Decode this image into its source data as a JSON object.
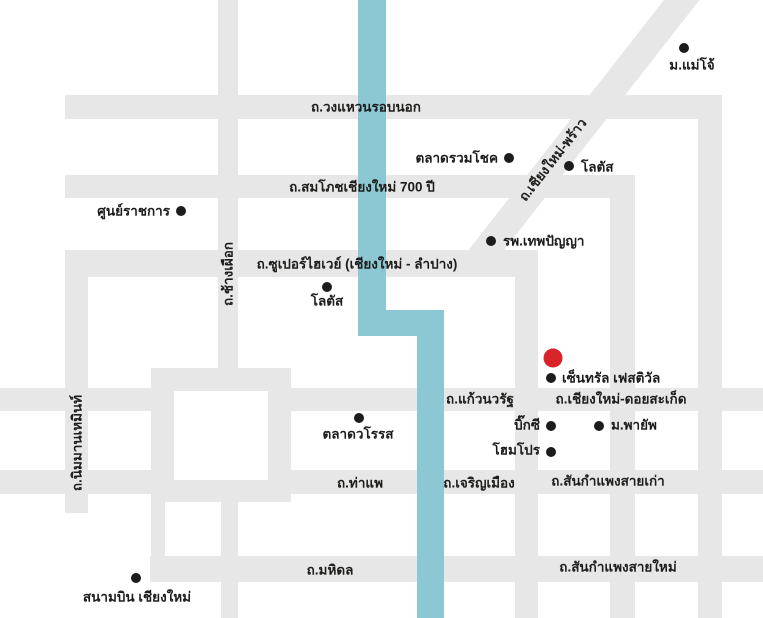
{
  "map": {
    "title": "chiangmai-schematic-map",
    "colors": {
      "background": "#ffffff",
      "road": "#e7e7e7",
      "river": "#8cc7d4",
      "marker": "#1c1c1c",
      "highlight": "#d8232b",
      "label": "#1d1d1b"
    },
    "road_segments": [
      {
        "id": "outer-ring-north",
        "rect": [
          65,
          95,
          657,
          24
        ]
      },
      {
        "id": "outer-ring-east",
        "rect": [
          698,
          95,
          24,
          523
        ]
      },
      {
        "id": "somphot-700pi",
        "rect": [
          65,
          175,
          570,
          23
        ]
      },
      {
        "id": "somphot-south-branch",
        "rect": [
          610,
          175,
          25,
          443
        ]
      },
      {
        "id": "superhighway",
        "rect": [
          65,
          250,
          473,
          27
        ]
      },
      {
        "id": "superhighway-south-branch",
        "rect": [
          515,
          250,
          23,
          368
        ]
      },
      {
        "id": "chiangmai-phrao-diagonal",
        "rect": [
          570,
          -50,
          28,
          350
        ],
        "rotate": 38
      },
      {
        "id": "chang-phueak",
        "rect": [
          218,
          0,
          20,
          391
        ]
      },
      {
        "id": "nimmanhaemin",
        "rect": [
          65,
          250,
          23,
          263
        ]
      },
      {
        "id": "kaew-nawarat-west",
        "rect": [
          0,
          388,
          174,
          23
        ]
      },
      {
        "id": "doi-saket",
        "rect": [
          268,
          388,
          495,
          23
        ]
      },
      {
        "id": "tha-phae-west",
        "rect": [
          0,
          470,
          174,
          24
        ]
      },
      {
        "id": "charoen-mueang-east",
        "rect": [
          268,
          470,
          495,
          24
        ]
      },
      {
        "id": "mahidol",
        "rect": [
          150,
          556,
          613,
          26
        ]
      },
      {
        "id": "moat-square-top",
        "rect": [
          151,
          368,
          140,
          23
        ]
      },
      {
        "id": "moat-square-bottom",
        "rect": [
          151,
          480,
          140,
          22
        ]
      },
      {
        "id": "moat-square-west",
        "rect": [
          151,
          368,
          23,
          134
        ]
      },
      {
        "id": "moat-square-east",
        "rect": [
          268,
          368,
          23,
          134
        ]
      },
      {
        "id": "moat-stub-southwest",
        "rect": [
          151,
          495,
          14,
          65
        ]
      },
      {
        "id": "moat-stub-airport-line",
        "rect": [
          221,
          495,
          17,
          123
        ]
      }
    ],
    "road_labels": [
      {
        "id": "wong-waen-rob-nok",
        "text": "ถ.วงแหวนรอบนอก",
        "x": 366,
        "y": 107,
        "rotate": 0
      },
      {
        "id": "somphot-700pi",
        "text": "ถ.สมโภชเชียงใหม่ 700 ปี",
        "x": 362,
        "y": 187,
        "rotate": 0
      },
      {
        "id": "superhighway",
        "text": "ถ.ซูเปอร์ไฮเวย์ (เชียงใหม่ - ลำปาง)",
        "x": 357,
        "y": 264,
        "rotate": 0
      },
      {
        "id": "chiangmai-phrao",
        "text": "ถ.เชียงใหม่-พร้าว",
        "x": 553,
        "y": 160,
        "rotate": -52
      },
      {
        "id": "chang-phueak",
        "text": "ถ.ช้างเผือก",
        "x": 228,
        "y": 274,
        "rotate": -90
      },
      {
        "id": "nimmanhaemin",
        "text": "ถ.นิมมานเหมินท์",
        "x": 77,
        "y": 443,
        "rotate": -90
      },
      {
        "id": "kaew-nawarat",
        "text": "ถ.แก้วนวรัฐ",
        "x": 480,
        "y": 399,
        "rotate": 0
      },
      {
        "id": "chiangmai-doi-saket",
        "text": "ถ.เชียงใหม่-ดอยสะเก็ด",
        "x": 621,
        "y": 399,
        "rotate": 0
      },
      {
        "id": "tha-phae",
        "text": "ถ.ท่าแพ",
        "x": 360,
        "y": 483,
        "rotate": 0
      },
      {
        "id": "charoen-mueang",
        "text": "ถ.เจริญเมือง",
        "x": 479,
        "y": 483,
        "rotate": 0
      },
      {
        "id": "sankamphaeng-old",
        "text": "ถ.สันกำแพงสายเก่า",
        "x": 608,
        "y": 481,
        "rotate": 0
      },
      {
        "id": "mahidol",
        "text": "ถ.มหิดล",
        "x": 330,
        "y": 570,
        "rotate": 0
      },
      {
        "id": "sankamphaeng-new",
        "text": "ถ.สันกำแพงสายใหม่",
        "x": 618,
        "y": 567,
        "rotate": 0
      }
    ],
    "river_segments": [
      {
        "id": "river-north",
        "rect": [
          358,
          0,
          28,
          336
        ]
      },
      {
        "id": "river-bend",
        "rect": [
          358,
          310,
          86,
          26
        ]
      },
      {
        "id": "river-south",
        "rect": [
          417,
          310,
          27,
          308
        ]
      }
    ],
    "pois": [
      {
        "id": "maejo-university",
        "text": "ม.แม่โจ้",
        "dot": [
          684,
          48
        ],
        "label": {
          "x": 692,
          "y": 65,
          "align": "center"
        }
      },
      {
        "id": "ruamchok-market",
        "text": "ตลาดรวมโชค",
        "dot": [
          509,
          158
        ],
        "label": {
          "x": 498,
          "y": 158,
          "align": "right"
        }
      },
      {
        "id": "lotus-north",
        "text": "โลตัส",
        "dot": [
          569,
          166
        ],
        "label": {
          "x": 581,
          "y": 167,
          "align": "left"
        }
      },
      {
        "id": "theppanya-hospital",
        "text": "รพ.เทพปัญญา",
        "dot": [
          491,
          241
        ],
        "label": {
          "x": 503,
          "y": 241,
          "align": "left"
        }
      },
      {
        "id": "government-center",
        "text": "ศูนย์ราชการ",
        "dot": [
          181,
          211
        ],
        "label": {
          "x": 170,
          "y": 211,
          "align": "right"
        }
      },
      {
        "id": "lotus-south",
        "text": "โลตัส",
        "dot": [
          327,
          287
        ],
        "label": {
          "x": 327,
          "y": 301,
          "align": "center"
        }
      },
      {
        "id": "warorot-market",
        "text": "ตลาดวโรรส",
        "dot": [
          359,
          418
        ],
        "label": {
          "x": 358,
          "y": 434,
          "align": "center"
        }
      },
      {
        "id": "central-festival",
        "text": "เซ็นทรัล เฟสติวัล",
        "dot": [
          551,
          378
        ],
        "label": {
          "x": 562,
          "y": 378,
          "align": "left"
        },
        "highlight": [
          553,
          358
        ]
      },
      {
        "id": "big-c",
        "text": "บิ๊กซี",
        "dot": [
          551,
          426
        ],
        "label": {
          "x": 540,
          "y": 425,
          "align": "right"
        }
      },
      {
        "id": "payap-university",
        "text": "ม.พายัพ",
        "dot": [
          599,
          426
        ],
        "label": {
          "x": 611,
          "y": 425,
          "align": "left"
        }
      },
      {
        "id": "homepro",
        "text": "โฮมโปร",
        "dot": [
          551,
          452
        ],
        "label": {
          "x": 540,
          "y": 450,
          "align": "right"
        }
      },
      {
        "id": "chiangmai-airport",
        "text": "สนามบิน เชียงใหม่",
        "dot": [
          136,
          578
        ],
        "label": {
          "x": 137,
          "y": 597,
          "align": "center"
        }
      }
    ]
  }
}
